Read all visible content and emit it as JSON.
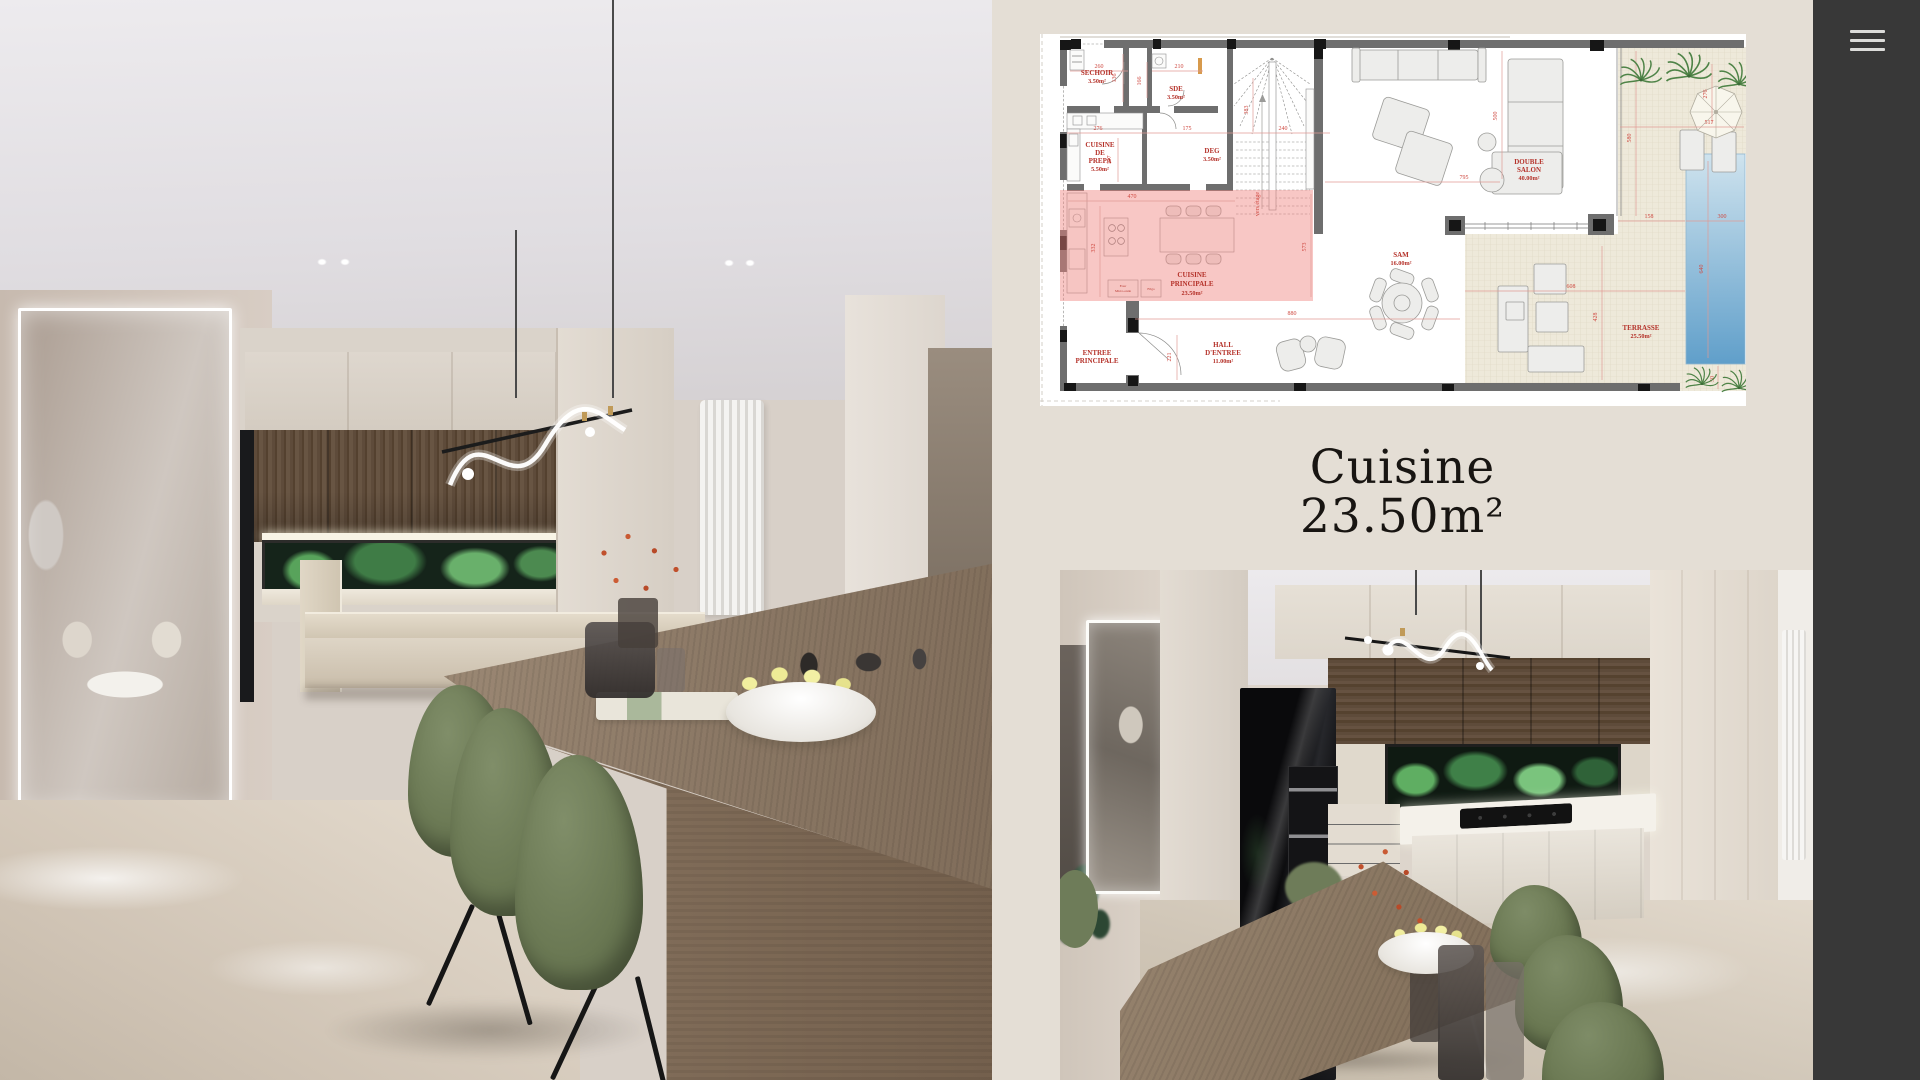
{
  "caption": {
    "title": "Cuisine",
    "area": "23.50m²"
  },
  "sidebar": {
    "icon": "hamburger-menu-icon"
  },
  "colors": {
    "panel_bg": "#e4ded5",
    "sidebar_bg": "#383838",
    "plan_label_red": "#b5322a",
    "dimension_red": "#cf4a42",
    "highlight_pink": "#f0837e",
    "pool_blue": "#609fca",
    "chair_green": "#6b7954",
    "wood_brown": "#8a7764"
  },
  "floorplan": {
    "rooms": {
      "sechoir": {
        "lines": [
          "SECHOIR",
          "3.50m²"
        ]
      },
      "sde": {
        "lines": [
          "SDE",
          "3.50m²"
        ]
      },
      "cuisine_prepa": {
        "lines": [
          "CUISINE",
          "DE",
          "PREPA",
          "5.50m²"
        ]
      },
      "deg": {
        "lines": [
          "DEG",
          "3.50m²"
        ]
      },
      "double_salon": {
        "lines": [
          "DOUBLE",
          "SALON",
          "40.00m²"
        ]
      },
      "cuisine_principale": {
        "lines": [
          "CUISINE",
          "PRINCIPALE",
          "23.50m²"
        ]
      },
      "sam": {
        "lines": [
          "SAM",
          "16.00m²"
        ]
      },
      "hall": {
        "lines": [
          "HALL",
          "D'ENTREE",
          "11.00m²"
        ]
      },
      "entree": {
        "lines": [
          "ENTREE",
          "PRINCIPALE"
        ]
      },
      "terrasse": {
        "lines": [
          "TERRASSE",
          "25.50m²"
        ]
      }
    },
    "appliances": {
      "oven": [
        "Four",
        "Micro-onde"
      ],
      "fridge": [
        "Frigo"
      ]
    },
    "stairs_note": "vers étage",
    "dims": {
      "sechoir_w": "260",
      "sechoir_d": "136",
      "sde_w": "210",
      "sde_d": "166",
      "prepa_w": "276",
      "prepa_d": "197",
      "deg_w": "175",
      "stairs_w": "240",
      "stairs_d": "383",
      "kitchen_w": "470",
      "kitchen_d": "332",
      "kitchen_l": "573",
      "hall_w": "880",
      "hall_d": "221",
      "salon_w": "795",
      "salon_d": "500",
      "terrace_top_w": "158",
      "pool_w": "300",
      "pool_l": "640",
      "terrace_top_d": "580",
      "terrace_w": "608",
      "terrace_d": "428",
      "garden_d": "276",
      "garden_w": "517",
      "palm_gap": "50"
    }
  }
}
